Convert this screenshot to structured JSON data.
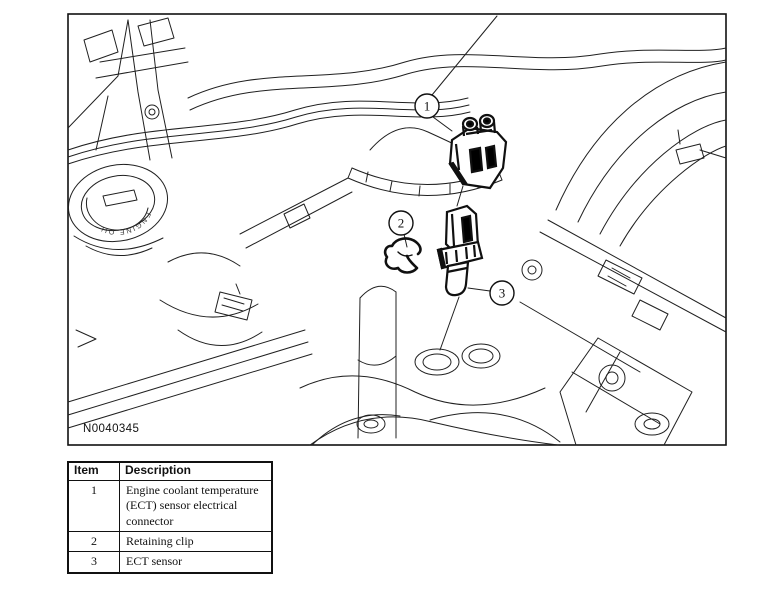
{
  "figure": {
    "id_label": "N0040345",
    "oil_cap_text": "ENGINE OIL",
    "callouts": {
      "c1": "1",
      "c2": "2",
      "c3": "3"
    }
  },
  "table": {
    "header_item": "Item",
    "header_description": "Description",
    "rows": [
      {
        "item": "1",
        "description": "Engine coolant temperature (ECT) sensor electrical connector"
      },
      {
        "item": "2",
        "description": "Retaining clip"
      },
      {
        "item": "3",
        "description": "ECT sensor"
      }
    ]
  },
  "colors": {
    "line": "#202020",
    "background": "#ffffff"
  }
}
